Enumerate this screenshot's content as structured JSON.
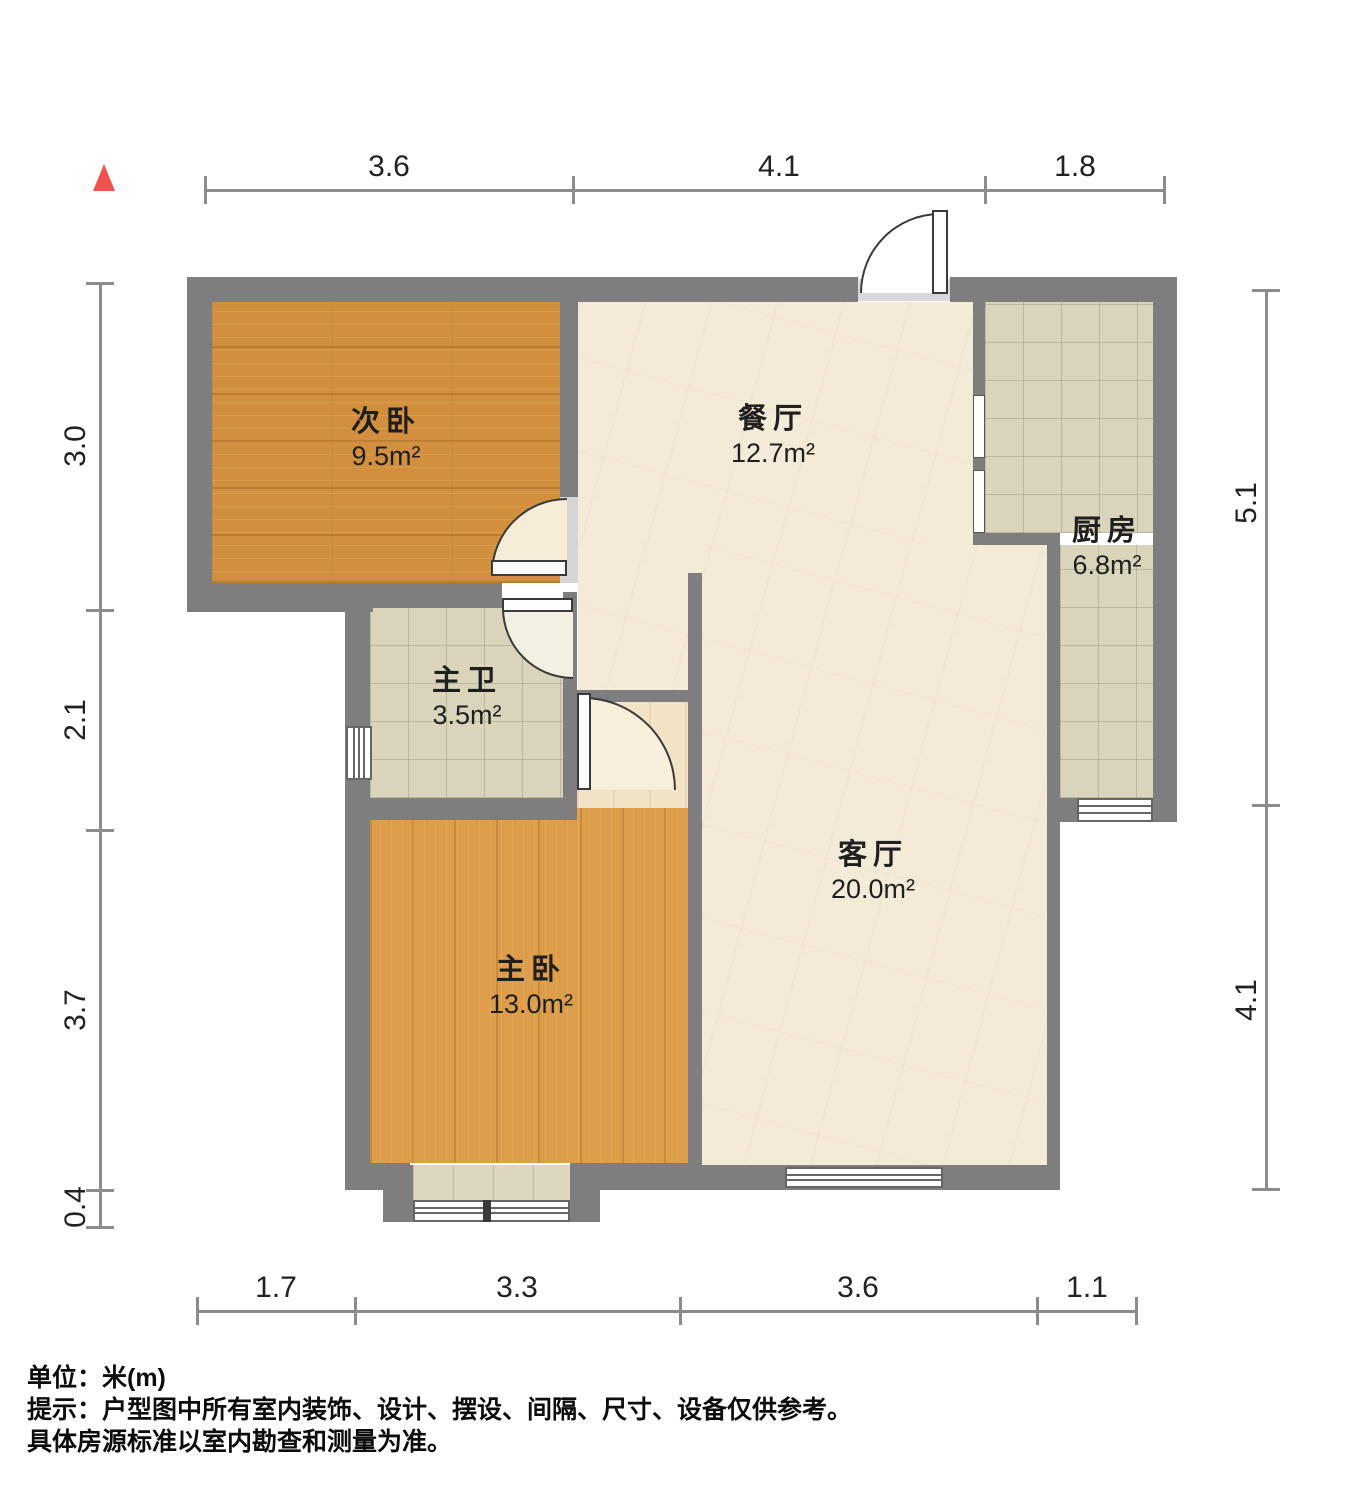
{
  "rooms": {
    "secondary_bedroom": {
      "name": "次卧",
      "area": "9.5m²"
    },
    "dining": {
      "name": "餐厅",
      "area": "12.7m²"
    },
    "kitchen": {
      "name": "厨房",
      "area": "6.8m²"
    },
    "master_bath": {
      "name": "主卫",
      "area": "3.5m²"
    },
    "master_bedroom": {
      "name": "主卧",
      "area": "13.0m²"
    },
    "living": {
      "name": "客厅",
      "area": "20.0m²"
    }
  },
  "dims": {
    "top": [
      "3.6",
      "4.1",
      "1.8"
    ],
    "left": [
      "3.0",
      "2.1",
      "3.7",
      "0.4"
    ],
    "right": [
      "5.1",
      "4.1"
    ],
    "bottom": [
      "1.7",
      "3.3",
      "3.6",
      "1.1"
    ]
  },
  "footer": {
    "unit_line": "单位：米(m)",
    "tip_line1": "提示：户型图中所有室内装饰、设计、摆设、间隔、尺寸、设备仅供参考。",
    "tip_line2": "具体房源标准以室内勘查和测量为准。"
  },
  "colors": {
    "wall": "#7e7e7e",
    "wall_light": "#d8d8d8",
    "marble": "#f3ebd8",
    "tile": "#d9d4ba",
    "wood_dark": "#d2903f",
    "wood_light": "#dd9d4b",
    "nook": "#f2e3c6",
    "dim_line": "#8c8c8c",
    "ink": "#1c1c1c",
    "north_arrow": "#f2504e",
    "door_stroke": "#3a3a3a"
  }
}
